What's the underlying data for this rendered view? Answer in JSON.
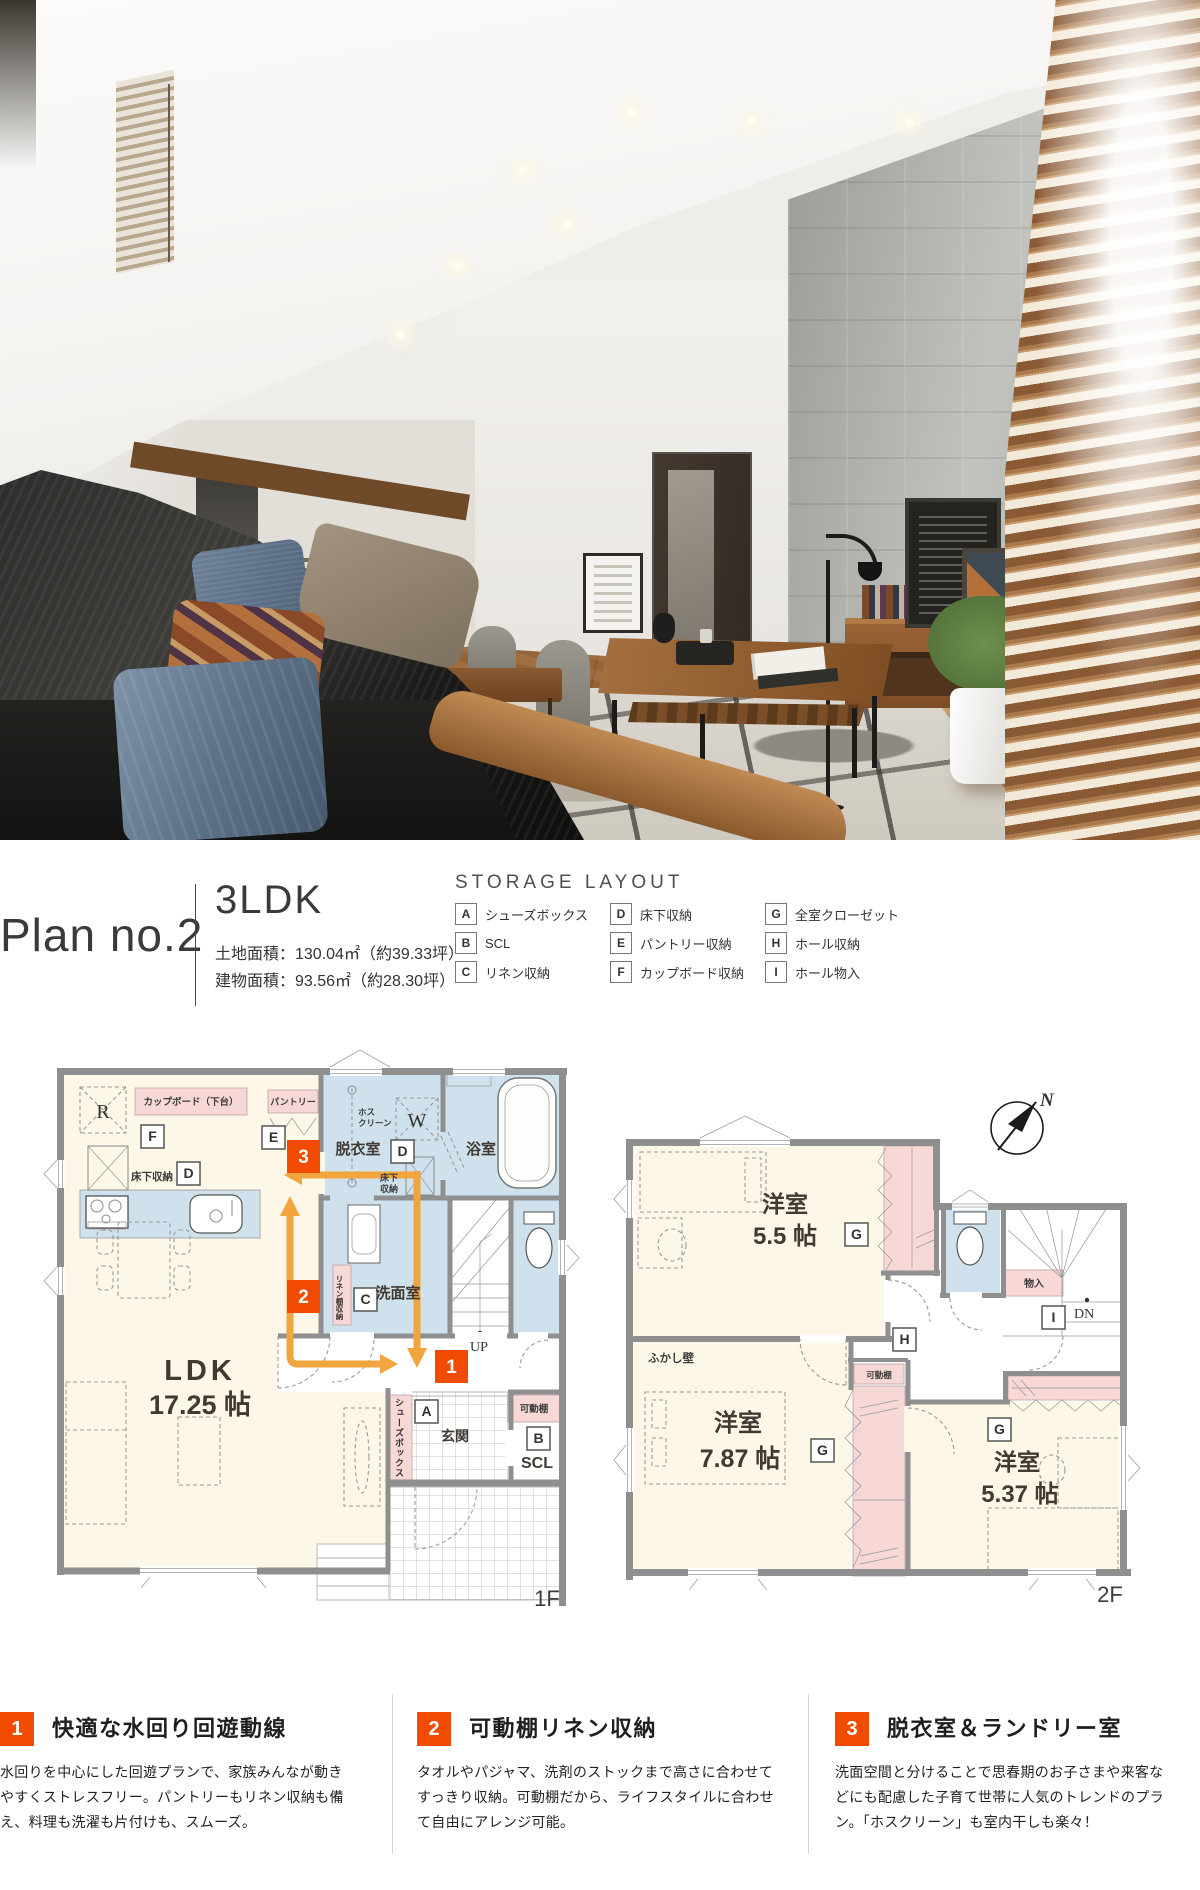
{
  "header": {
    "plan_label": "Plan no.2",
    "type": "3LDK",
    "land_area": "土地面積：130.04㎡（約39.33坪）",
    "building_area": "建物面積：93.56㎡（約28.30坪）",
    "storage_title": "STORAGE LAYOUT",
    "legend": [
      {
        "key": "A",
        "label": "シューズボックス"
      },
      {
        "key": "B",
        "label": "SCL"
      },
      {
        "key": "C",
        "label": "リネン収納"
      },
      {
        "key": "D",
        "label": "床下収納"
      },
      {
        "key": "E",
        "label": "パントリー収納"
      },
      {
        "key": "F",
        "label": "カップボード収納"
      },
      {
        "key": "G",
        "label": "全室クローゼット"
      },
      {
        "key": "H",
        "label": "ホール収納"
      },
      {
        "key": "I",
        "label": "ホール物入"
      }
    ]
  },
  "letters": {
    "a": "A",
    "b": "B",
    "c": "C",
    "d": "D",
    "e": "E",
    "f": "F",
    "g": "G",
    "h": "H",
    "i": "I"
  },
  "badges": {
    "b1": "1",
    "b2": "2",
    "b3": "3"
  },
  "plan1f": {
    "label": "1F",
    "room_ldk_1": "LDK",
    "room_ldk_2": "17.25 帖",
    "room_datsui": "脱衣室",
    "room_bath": "浴室",
    "room_senmen": "洗面室",
    "room_genkan": "玄関",
    "room_scl": "SCL",
    "up": "UP",
    "r": "R",
    "w": "W",
    "cupboard": "カップボード（下台）",
    "pantry": "パントリー",
    "yukashita": "床下収納",
    "yukashita_l1": "床下",
    "yukashita_l2": "収納",
    "hoscreen_l1": "ホス",
    "hoscreen_l2": "クリーン",
    "linen_shelf": "リネン棚収納",
    "shoes_box": "シューズボックス",
    "movable_shelf": "可動棚"
  },
  "plan2f": {
    "label": "2F",
    "room1_1": "洋室",
    "room1_2": "5.5 帖",
    "room2_1": "洋室",
    "room2_2": "7.87 帖",
    "room3_1": "洋室",
    "room3_2": "5.37 帖",
    "fukashi": "ふかし壁",
    "movable_shelf": "可動棚",
    "monoire": "物入",
    "dn": "DN",
    "north": "N"
  },
  "sections": [
    {
      "num": "1",
      "title": "快適な水回り回遊動線",
      "body": "水回りを中心にした回遊プランで、家族みんなが動きやすくストレスフリー。パントリーもリネン収納も備え、料理も洗濯も片付けも、スムーズ。"
    },
    {
      "num": "2",
      "title": "可動棚リネン収納",
      "body": "タオルやパジャマ、洗剤のストックまで高さに合わせてすっきり収納。可動棚だから、ライフスタイルに合わせて自由にアレンジ可能。"
    },
    {
      "num": "3",
      "title": "脱衣室＆ランドリー室",
      "body": "洗面空間と分けることで思春期のお子さまや来客などにも配慮した子育て世帯に人気のトレンドのプラン。「ホスクリーン」も室内干しも楽々！"
    }
  ],
  "colors": {
    "accent_badge": "#f04b00",
    "arrow_orange": "#f2a43e",
    "room_cream": "#fcf7e6",
    "wet_blue": "#cfe1ec",
    "storage_pink": "#f8d7d7",
    "wall_gray": "#8f8f8f"
  }
}
